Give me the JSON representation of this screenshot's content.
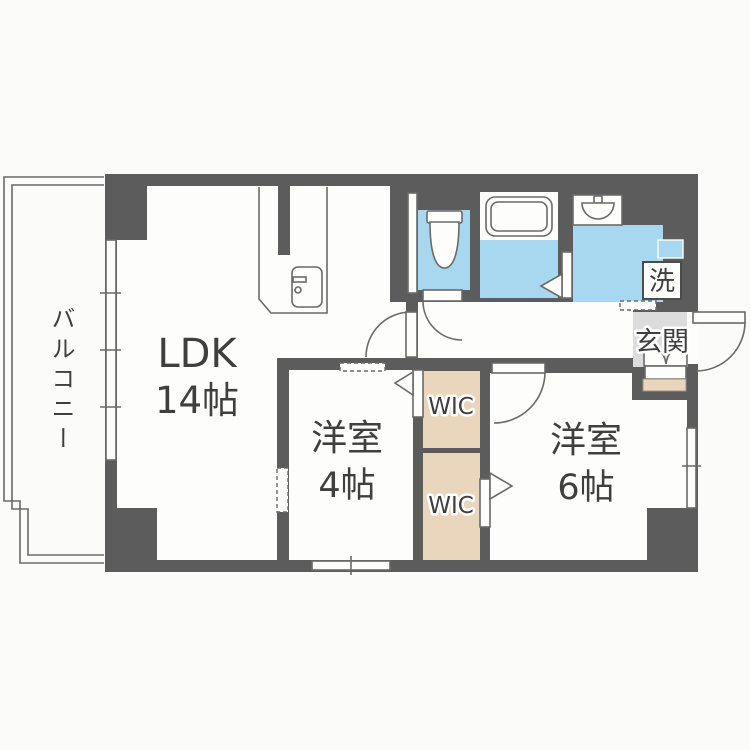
{
  "floorplan": {
    "title": "apartment-floor-plan-1LDK",
    "colors": {
      "bg": "#fbfbfa",
      "wall": "#5c5c5c",
      "floor": "#fdfdfc",
      "water": "#a8d8f0",
      "closet": "#e9d6bc",
      "gfloor": "#dcdcdc",
      "line": "#6a6a6a",
      "ink": "#3f3f3f"
    },
    "labels": {
      "balcony": "バルコニー",
      "ldk_name": "LDK",
      "ldk_size": "14帖",
      "bedroom1_name": "洋室",
      "bedroom1_size": "4帖",
      "bedroom2_name": "洋室",
      "bedroom2_size": "6帖",
      "wic_top": "WIC",
      "wic_bottom": "WIC",
      "entrance": "玄関",
      "laundry": "洗"
    }
  }
}
